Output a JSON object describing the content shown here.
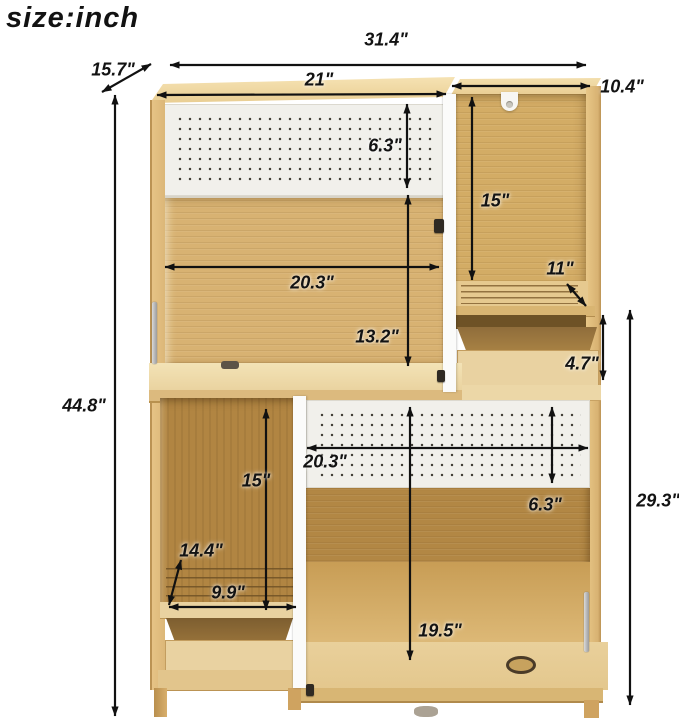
{
  "title": "size:inch",
  "dimensions": {
    "overall_width": "31.4\"",
    "depth": "15.7\"",
    "hutch_top_width": "21\"",
    "right_top_width": "10.4\"",
    "top_pegboard_height": "6.3\"",
    "right_compartment_height": "15\"",
    "right_shelf_depth": "11\"",
    "upper_opening_width": "20.3\"",
    "upper_opening_height": "13.2\"",
    "right_drawer_height": "4.7\"",
    "lower_right_height": "29.3\"",
    "overall_height": "44.8\"",
    "lower_opening_width": "20.3\"",
    "lower_pegboard_height": "6.3\"",
    "lower_left_height": "15\"",
    "lower_shelf_diagonal": "14.4\"",
    "lower_shelf_width": "9.9\"",
    "lower_compartment_height": "19.5\""
  },
  "colors": {
    "wood_light": "#eed69f",
    "wood_medium": "#d6b170",
    "wood_dark": "#b08341",
    "pegboard": "#f1f0eb",
    "arrow": "#111111"
  }
}
